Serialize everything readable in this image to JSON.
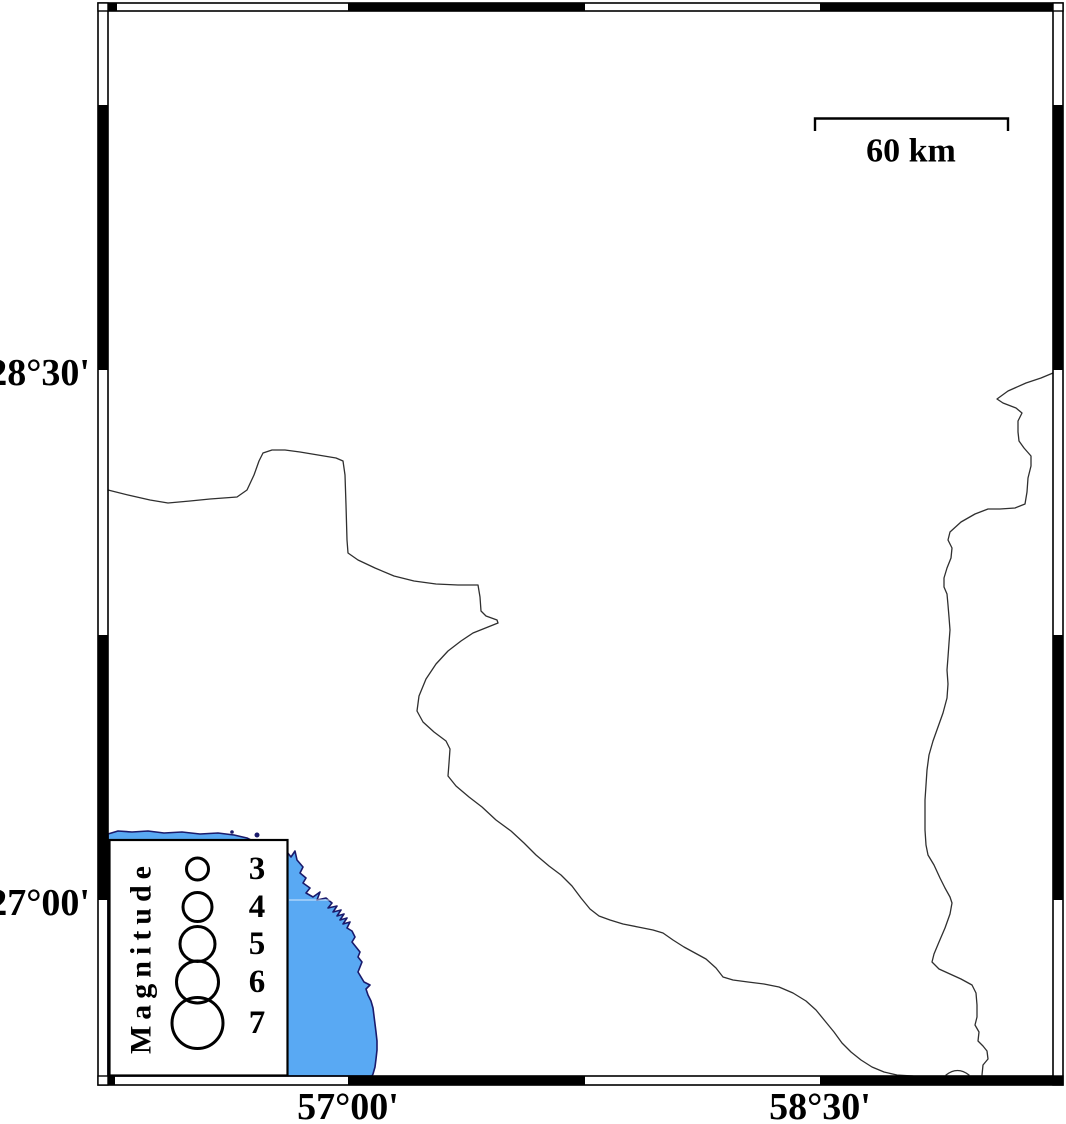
{
  "map": {
    "axis": {
      "left": [
        {
          "text": "28°30'",
          "y": 373
        },
        {
          "text": "27°00'",
          "y": 903
        }
      ],
      "bottom": [
        {
          "text": "57°00'",
          "x": 348
        },
        {
          "text": "58°30'",
          "x": 820
        }
      ]
    },
    "scale_bar": {
      "label": "60 km"
    },
    "legend": {
      "title": "Magnitude",
      "entries": [
        {
          "magnitude": "3",
          "radius_px": 11,
          "center_y_px": 869
        },
        {
          "magnitude": "4",
          "radius_px": 14.5,
          "center_y_px": 907
        },
        {
          "magnitude": "5",
          "radius_px": 17.5,
          "center_y_px": 944
        },
        {
          "magnitude": "6",
          "radius_px": 21,
          "center_y_px": 982
        },
        {
          "magnitude": "7",
          "radius_px": 25.5,
          "center_y_px": 1023
        }
      ]
    },
    "colors": {
      "sea": "#59a9f3",
      "coastline": "#1a1a6b",
      "boundary": "#2f2f2f",
      "frame": "#000000",
      "background": "#ffffff"
    }
  }
}
